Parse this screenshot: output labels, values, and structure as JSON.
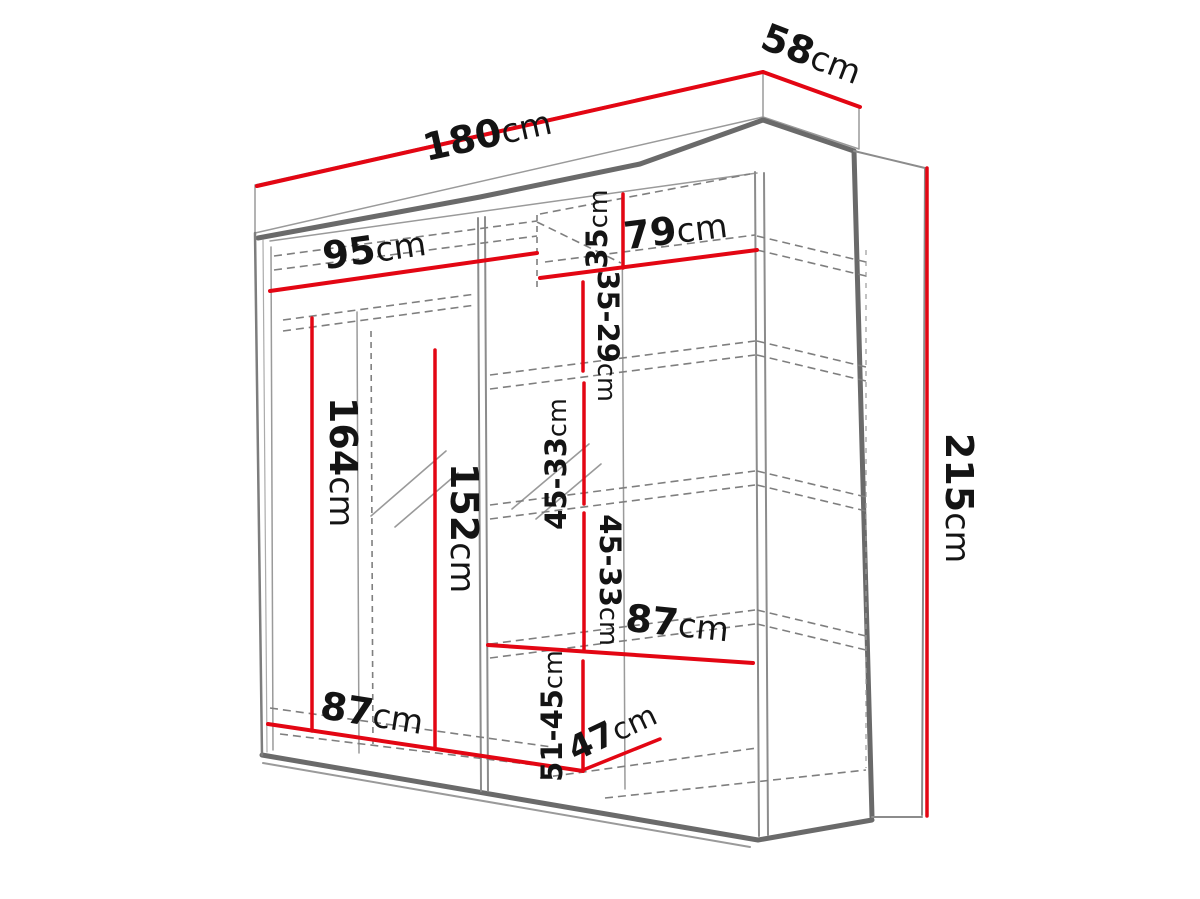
{
  "figure": {
    "title": "Wardrobe dimension diagram",
    "subject": "two-door sliding wardrobe with shelves and hanging rail",
    "accent_color": "#e30613",
    "line_color": "#6a6a6a",
    "background_color": "#ffffff"
  },
  "dims": [
    {
      "id": "overall-width",
      "value": "180",
      "unit": "cm"
    },
    {
      "id": "overall-depth",
      "value": "58",
      "unit": "cm"
    },
    {
      "id": "overall-height",
      "value": "215",
      "unit": "cm"
    },
    {
      "id": "left-section-width",
      "value": "95",
      "unit": "cm"
    },
    {
      "id": "right-section-width",
      "value": "79",
      "unit": "cm"
    },
    {
      "id": "left-interior-height",
      "value": "164",
      "unit": "cm"
    },
    {
      "id": "mirror-height",
      "value": "152",
      "unit": "cm"
    },
    {
      "id": "bottom-left-width",
      "value": "87",
      "unit": "cm"
    },
    {
      "id": "right-shelf-width",
      "value": "87",
      "unit": "cm"
    },
    {
      "id": "top-shelf-height",
      "value": "35",
      "unit": "cm"
    },
    {
      "id": "shelf-gap-1",
      "value": "35-29",
      "unit": "cm"
    },
    {
      "id": "shelf-gap-2",
      "value": "45-33",
      "unit": "cm"
    },
    {
      "id": "shelf-gap-3",
      "value": "45-33",
      "unit": "cm"
    },
    {
      "id": "bottom-shelf-height",
      "value": "51-45",
      "unit": "cm"
    },
    {
      "id": "shelf-depth",
      "value": "47",
      "unit": "cm"
    }
  ]
}
